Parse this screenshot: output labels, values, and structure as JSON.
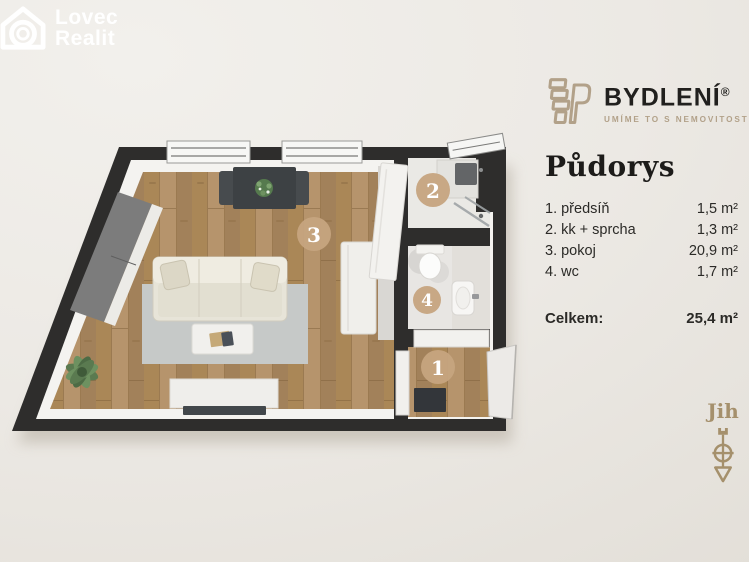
{
  "lovec_logo": {
    "line1": "Lovec",
    "line2": "Realit"
  },
  "bydleni_logo": {
    "name": "BYDLENÍ",
    "registered": "®",
    "tagline": "UMÍME TO S NEMOVITOSTMI"
  },
  "panel": {
    "title": "Půdorys",
    "rooms": [
      {
        "label": "1. předsíň",
        "area": "1,5 m²"
      },
      {
        "label": "2. kk + sprcha",
        "area": "1,3 m²"
      },
      {
        "label": "3. pokoj",
        "area": "20,9 m²"
      },
      {
        "label": "4. wc",
        "area": "1,7 m²"
      }
    ],
    "total_label": "Celkem:",
    "total_area": "25,4 m²"
  },
  "compass": {
    "direction_label": "Jih"
  },
  "plan": {
    "room_markers": [
      {
        "number": "1"
      },
      {
        "number": "2"
      },
      {
        "number": "3"
      },
      {
        "number": "4"
      }
    ]
  },
  "colors": {
    "brand_tan": "#b2a189",
    "marker_tan": "#c6a47f",
    "wall_dark": "#2e2d2c",
    "wood": "#b08e63",
    "background_beige": "#ece9e4"
  }
}
